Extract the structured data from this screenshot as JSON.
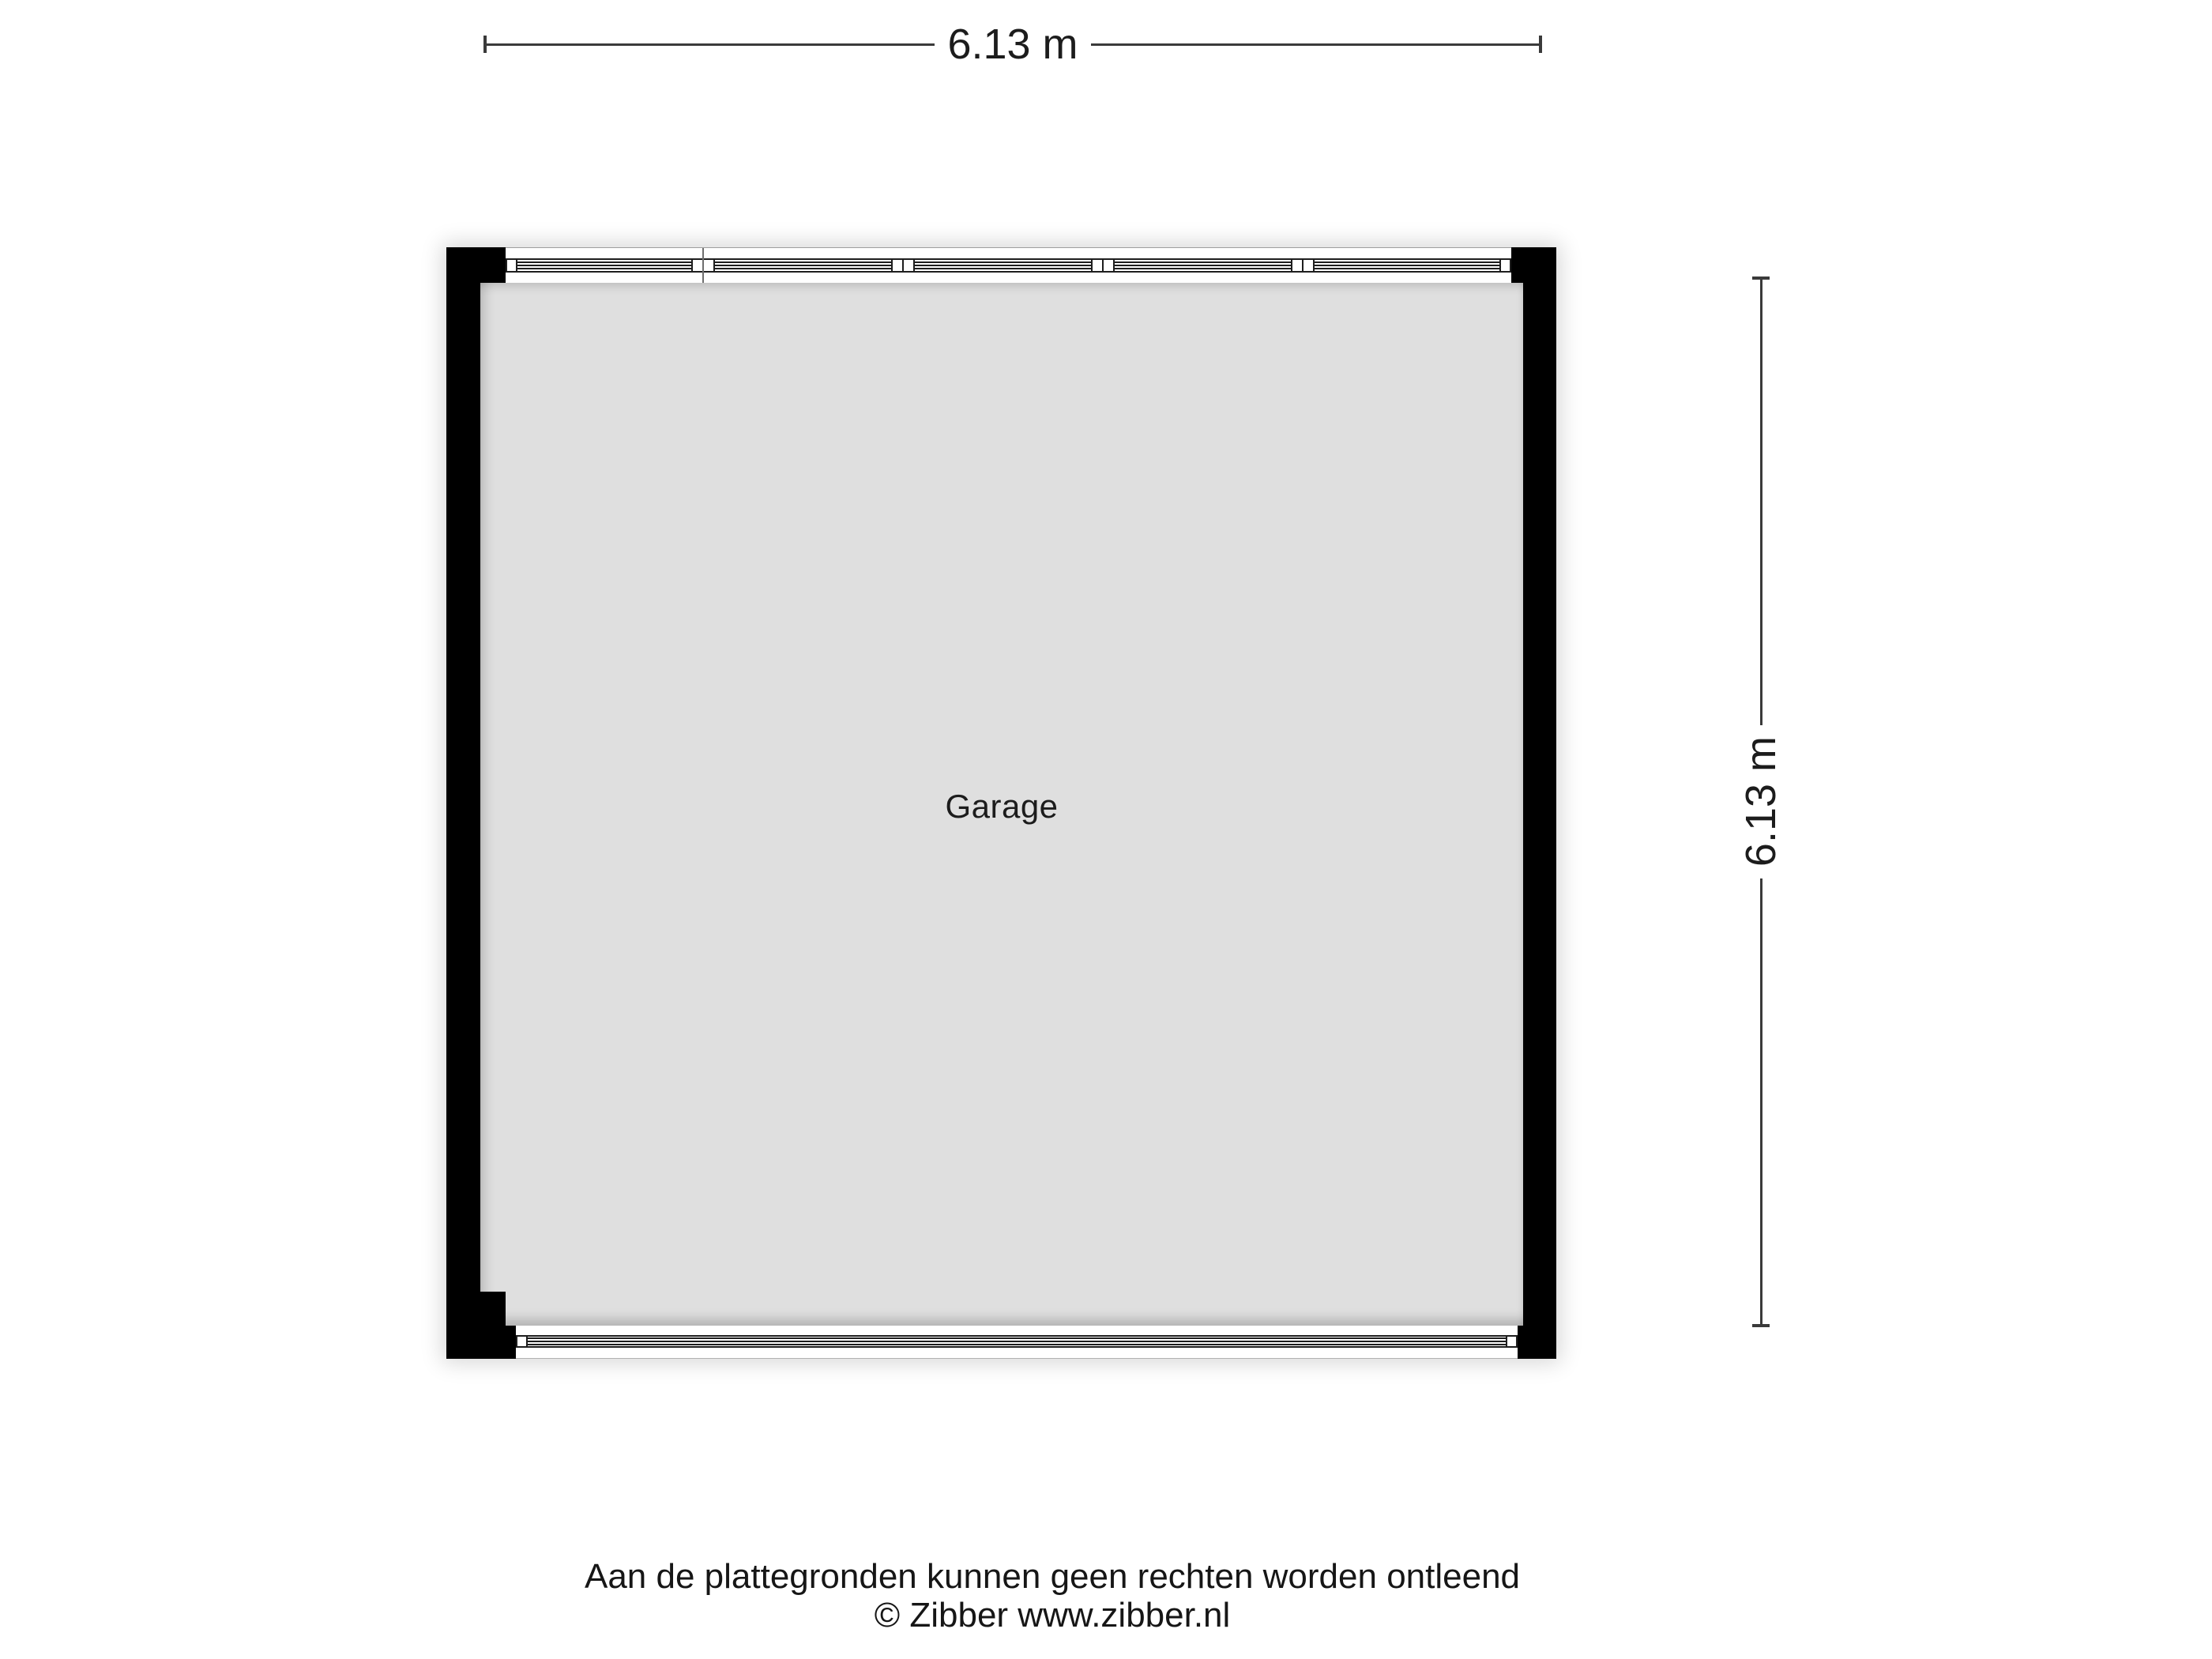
{
  "floorplan": {
    "room": {
      "label": "Garage"
    },
    "dimensions": {
      "width": "6.13 m",
      "height": "6.13 m"
    },
    "colors": {
      "wall": "#000000",
      "floor": "#dfdfdf",
      "window_frame": "#1e1e1e",
      "dimension_line": "#3a3a3a",
      "text": "#1c1c1c",
      "background": "#ffffff"
    }
  },
  "footer": {
    "disclaimer": "Aan de plattegronden kunnen geen rechten worden ontleend",
    "copyright": "© Zibber www.zibber.nl"
  }
}
